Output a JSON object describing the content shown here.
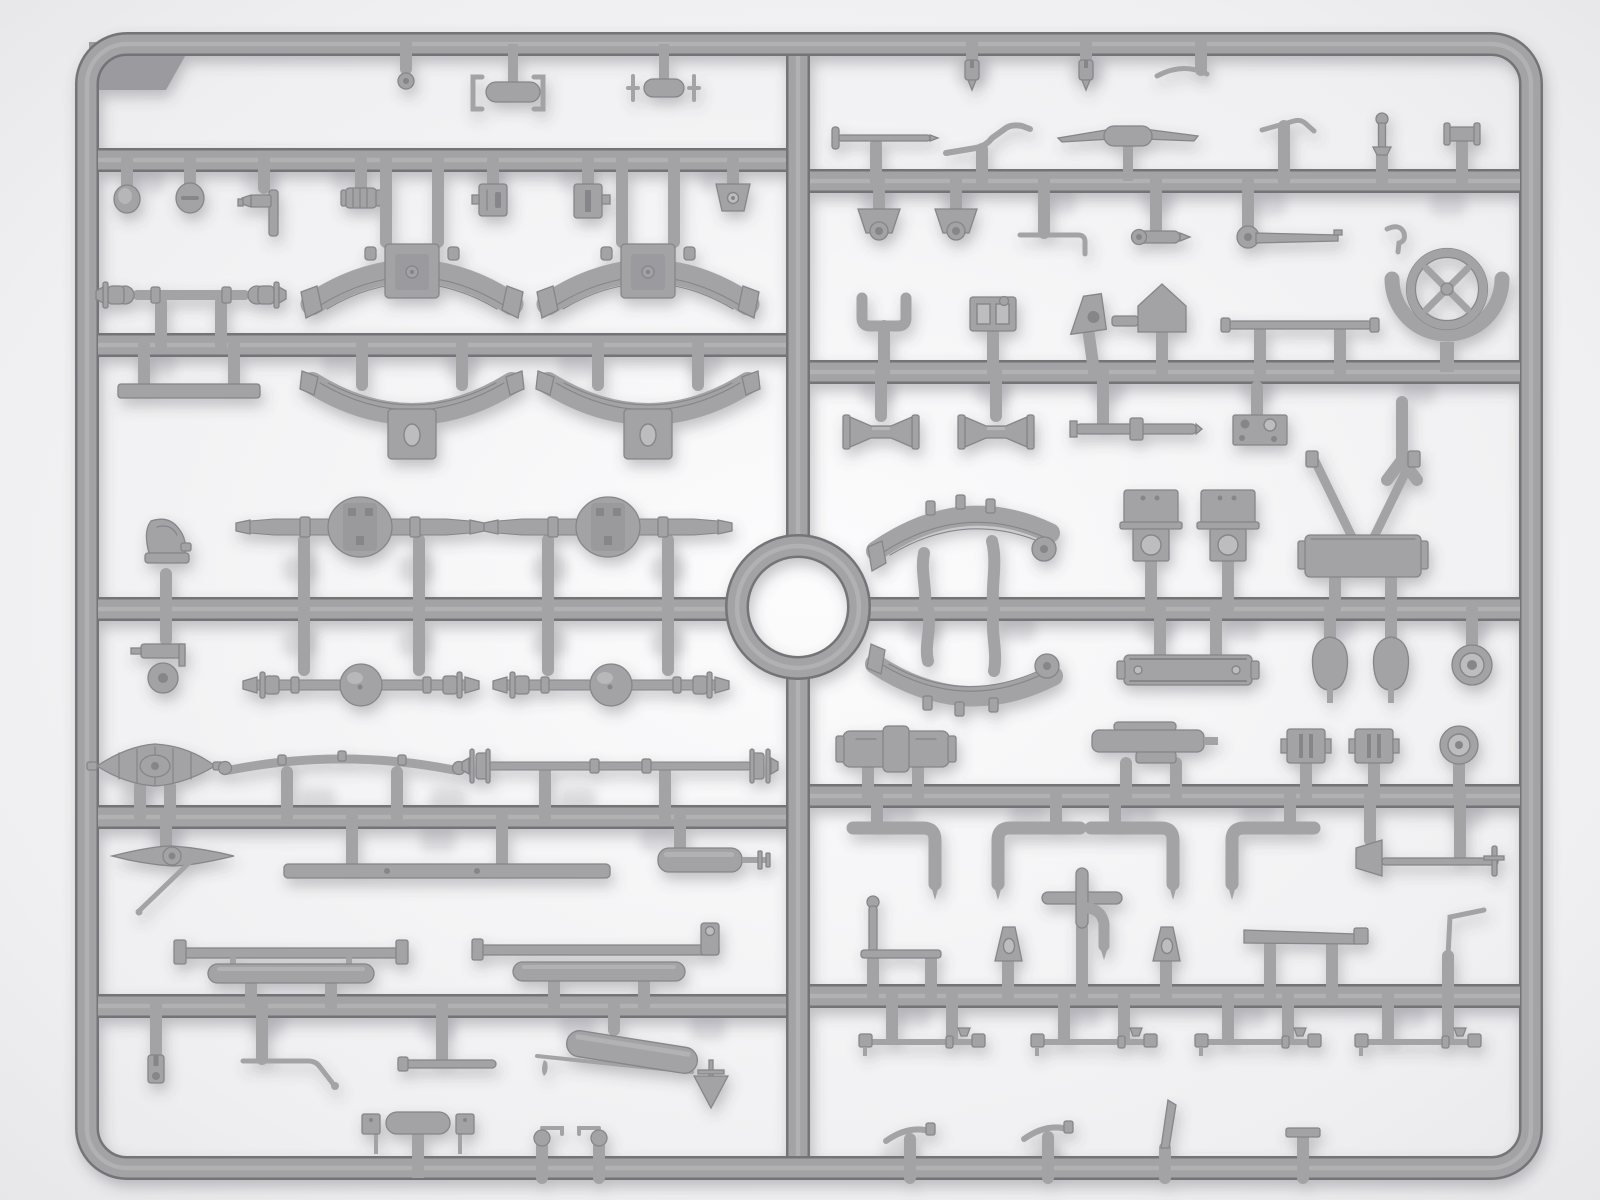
{
  "scene": {
    "subject": "Gray injection-molded plastic model-kit sprue with truck chassis parts",
    "style": "top-down product photograph, soft shadows on light background",
    "grid": {
      "columns": 2,
      "runner_rows": 6,
      "center_ring": true
    },
    "total_parts_approx": 96
  },
  "palette": {
    "bg-edge": "#e4e4e7",
    "bg-center": "#fcfcfd",
    "plastic": "#a3a3a6",
    "plastic-light": "#bdbdc0",
    "plastic-dark": "#85858a",
    "plastic-edge": "#737378",
    "ghost": "#c7c7cc",
    "tab": "#9a9a9f"
  },
  "inventory": {
    "left_half": [
      {
        "name": "molded label tab",
        "qty": 1
      },
      {
        "name": "washer",
        "qty": 1
      },
      {
        "name": "frame clamp bracket",
        "qty": 4
      },
      {
        "name": "tow hook tee",
        "qty": 2
      },
      {
        "name": "round cap",
        "qty": 2
      },
      {
        "name": "valve fitting",
        "qty": 1
      },
      {
        "name": "ribbed cylinder plug",
        "qty": 1
      },
      {
        "name": "clip block",
        "qty": 2
      },
      {
        "name": "trapezoid bracket",
        "qty": 1
      },
      {
        "name": "arched leaf spring",
        "qty": 2
      },
      {
        "name": "inverted leaf spring",
        "qty": 2
      },
      {
        "name": "universal joint shaft",
        "qty": 1
      },
      {
        "name": "mounting strip",
        "qty": 1
      },
      {
        "name": "front axle with differential",
        "qty": 2
      },
      {
        "name": "rear axle with ball differential",
        "qty": 2
      },
      {
        "name": "steering knuckle upper",
        "qty": 1
      },
      {
        "name": "steering knuckle with wheel",
        "qty": 1
      },
      {
        "name": "finned cover",
        "qty": 1
      },
      {
        "name": "auxiliary flat leaf spring",
        "qty": 1
      },
      {
        "name": "flanged axle rod",
        "qty": 1
      },
      {
        "name": "steering arm with drag link",
        "qty": 1
      },
      {
        "name": "chassis crossmember bar",
        "qty": 1
      },
      {
        "name": "muffler stub with shaft",
        "qty": 1
      },
      {
        "name": "side rail assembly",
        "qty": 2
      },
      {
        "name": "clevis",
        "qty": 1
      },
      {
        "name": "bent brake rod",
        "qty": 1
      },
      {
        "name": "short link rod",
        "qty": 1
      },
      {
        "name": "exhaust with muffler and funnel",
        "qty": 1
      },
      {
        "name": "tee bracket with clips",
        "qty": 1
      },
      {
        "name": "ball-end lever",
        "qty": 2
      }
    ],
    "right_half": [
      {
        "name": "hinge pin",
        "qty": 2
      },
      {
        "name": "curved strip",
        "qty": 1
      },
      {
        "name": "control rod with handle",
        "qty": 1
      },
      {
        "name": "shift lever",
        "qty": 1
      },
      {
        "name": "propeller tee handle",
        "qty": 1
      },
      {
        "name": "bent lever",
        "qty": 1
      },
      {
        "name": "valve stem pin",
        "qty": 1
      },
      {
        "name": "flanged pin",
        "qty": 1
      },
      {
        "name": "spring shackle bracket",
        "qty": 2
      },
      {
        "name": "elbow rod",
        "qty": 1
      },
      {
        "name": "drop arm lever",
        "qty": 1
      },
      {
        "name": "brake lever with boss",
        "qty": 1
      },
      {
        "name": "s-hook",
        "qty": 1
      },
      {
        "name": "steering wheel in cradle",
        "qty": 1
      },
      {
        "name": "u-bracket",
        "qty": 1
      },
      {
        "name": "plate with windows",
        "qty": 1
      },
      {
        "name": "gusset with hole",
        "qty": 1
      },
      {
        "name": "house bracket",
        "qty": 1
      },
      {
        "name": "capped thin bar",
        "qty": 1
      },
      {
        "name": "cable drum spool",
        "qty": 2
      },
      {
        "name": "collared shaft",
        "qty": 1
      },
      {
        "name": "drilled plate",
        "qty": 1
      },
      {
        "name": "y-pipe",
        "qty": 1
      },
      {
        "name": "a-frame with base",
        "qty": 1
      },
      {
        "name": "upper leaf spring",
        "qty": 1
      },
      {
        "name": "lower leaf spring",
        "qty": 1
      },
      {
        "name": "cab mount",
        "qty": 2
      },
      {
        "name": "mount plate with holes",
        "qty": 1
      },
      {
        "name": "teardrop ball",
        "qty": 2
      },
      {
        "name": "wheel hub",
        "qty": 2
      },
      {
        "name": "transfer case",
        "qty": 1
      },
      {
        "name": "pump assembly",
        "qty": 1
      },
      {
        "name": "gear block",
        "qty": 2
      },
      {
        "name": "elbow pipe",
        "qty": 4
      },
      {
        "name": "shovel rod",
        "qty": 1
      },
      {
        "name": "cross pipe with bend",
        "qty": 1
      },
      {
        "name": "hand brake lever",
        "qty": 1
      },
      {
        "name": "wedge bracket",
        "qty": 2
      },
      {
        "name": "tapered bar",
        "qty": 1
      },
      {
        "name": "z-rod",
        "qty": 1
      },
      {
        "name": "tie rod",
        "qty": 4
      },
      {
        "name": "curved clip",
        "qty": 2
      },
      {
        "name": "blade clip",
        "qty": 1
      },
      {
        "name": "flat stub",
        "qty": 1
      }
    ],
    "center": [
      {
        "name": "circular runner ring",
        "qty": 1
      }
    ]
  }
}
